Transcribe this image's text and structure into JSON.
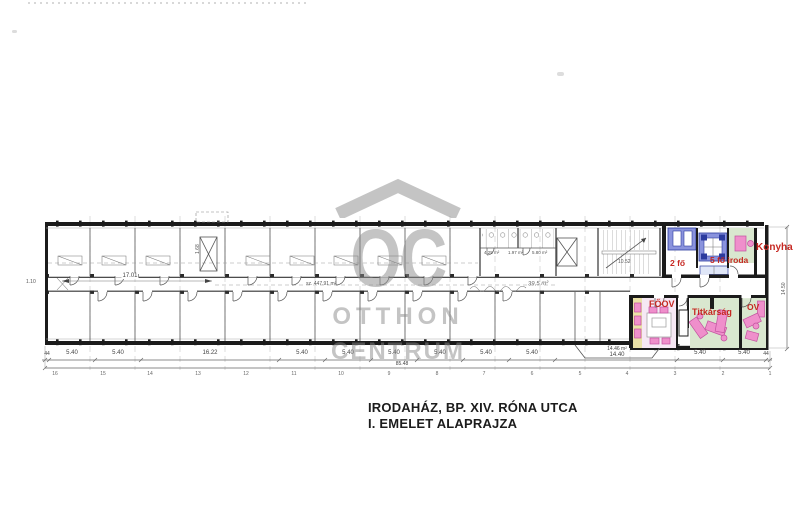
{
  "title": {
    "line1": "IRODAHÁZ, BP. XIV. RÓNA UTCA",
    "line2": "I. EMELET ALAPRAJZA"
  },
  "watermark": {
    "letters": "OC",
    "line1": "OTTHON",
    "line2": "CENTRUM"
  },
  "rooms": {
    "two_person": {
      "label": "2 fő"
    },
    "five_person": {
      "label": "5 fő iroda"
    },
    "kitchen": {
      "label": "Konyha"
    },
    "head_office": {
      "label": "FŐOV"
    },
    "secretariat": {
      "label": "Titkárság"
    },
    "ov_office": {
      "label": "OV"
    }
  },
  "dimensions": {
    "bottom_segments": [
      "44",
      "5.40",
      "5.40",
      "16.22",
      "5.40",
      "5.40",
      "5.40",
      "5.40",
      "5.40",
      "5.40",
      "14.40",
      "5.40",
      "5.40",
      "44"
    ],
    "total": "85.48",
    "corridor_length": "17.01",
    "corridor_width": "1.10",
    "right_height": "14.50",
    "bay_area": "14.46 m²",
    "corridor_area": "sz. 447.91 m²",
    "handwritten_area": "39,5 m²",
    "stair_area": "10.52",
    "shaft_width": "1.68",
    "wc_areas": [
      "4.25 m²",
      "1.97 m²",
      "5.80 m²"
    ]
  },
  "grid_numbers": [
    "16",
    "15",
    "14",
    "13",
    "12",
    "11",
    "10",
    "9",
    "8",
    "7",
    "6",
    "5",
    "4",
    "3",
    "2",
    "1"
  ],
  "colors": {
    "wall": "#1b1b1b",
    "line": "#555555",
    "room-red": "#c62822",
    "blue": "#8a93dd",
    "blue-dark": "#2c3b9e",
    "green": "#d9e7cf",
    "pink": "#ef8fcb",
    "pink-dark": "#c2519e",
    "lavender": "#f6e8f4",
    "yellow": "#eae2a8",
    "watermark": "#8a8a8a"
  }
}
